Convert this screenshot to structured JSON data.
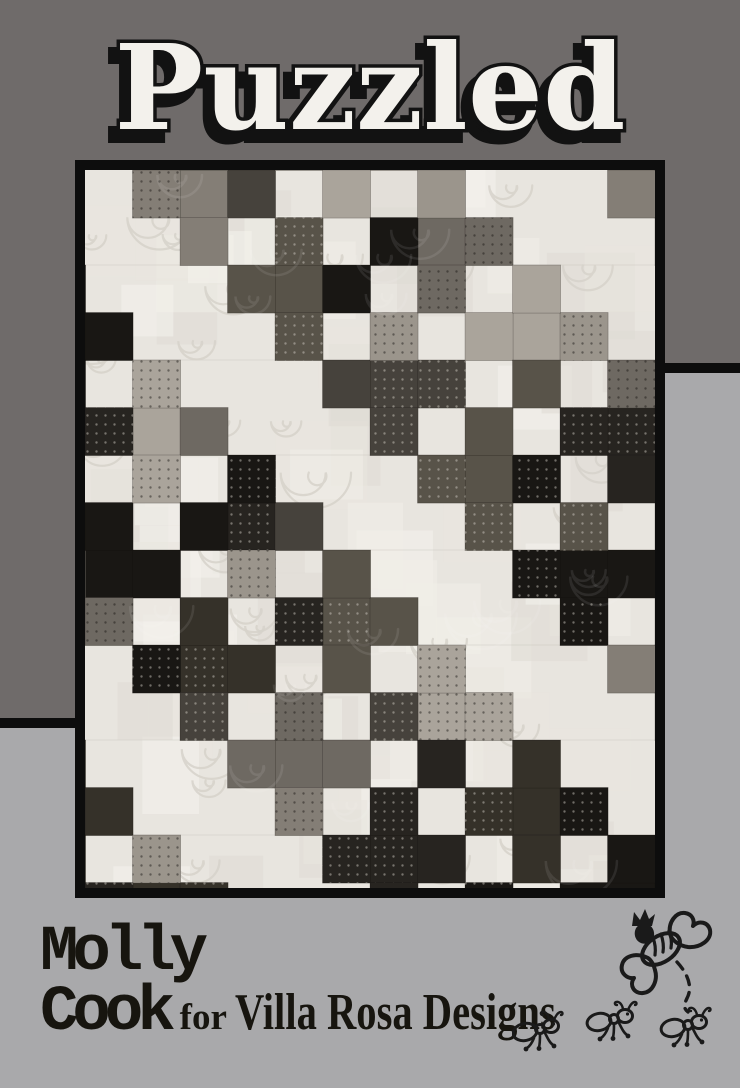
{
  "card": {
    "bg_dark": "#6f6b6a",
    "bg_light": "#a9a9ab",
    "divider": "#0d0d0d"
  },
  "title": {
    "text": "Puzzled",
    "fill": "#f3f1ec",
    "outline": "#121212"
  },
  "quilt_photo": {
    "frame": "#0d0d0d",
    "background": "#e8e5df",
    "quilting_thread": "#d6d2ca",
    "fabrics": [
      "#191714",
      "#272420",
      "#353129",
      "#46423c",
      "#585349",
      "#6e6962",
      "#847e76",
      "#9b958c",
      "#aaa49b"
    ],
    "description": "patchwork quilt of gray and black plus-sign blocks on cream swirl-quilted background"
  },
  "credits": {
    "designer_first": "Molly",
    "designer_last": "Cook",
    "connector": "for",
    "studio": "Villa Rosa Designs",
    "ink": "#17150f"
  },
  "doodles": {
    "ink": "#1a1a1a",
    "bee": "queen-bee-doodle",
    "ants": "three-marching-ants-doodle"
  }
}
